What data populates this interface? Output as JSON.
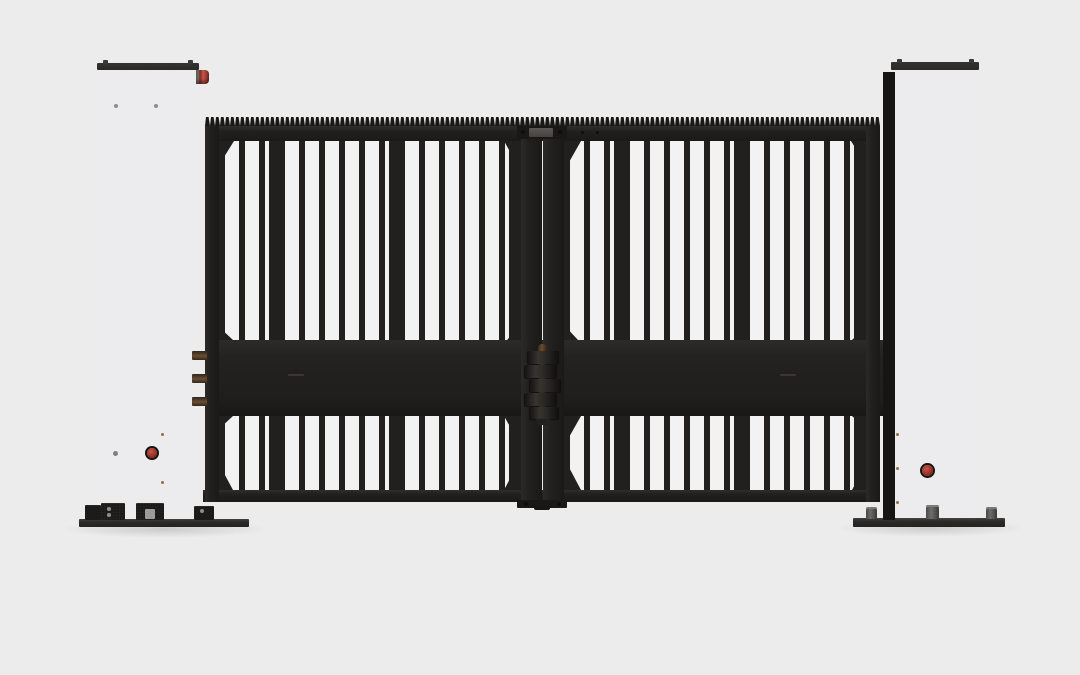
{
  "meta": {
    "type": "3d-product-render",
    "subject": "Black double-leaf swing gate with two square mounting posts on a plain light-gray studio background"
  },
  "scene": {
    "background": "plain light gray backdrop, no ground line",
    "left_post": "black square post with flat cap, two corner cap bolts, red side indicator light near the top right edge, two gray face bolts, red round button near the base, anchor base plate with fixing brackets and bolts",
    "right_post": "black square post with flat cap, corner cap bolts, visible darker left side face, red round button near the base, small side dots, anchor base plate with three anchor studs",
    "gate_left_leaf": "black leaf: serrated gear-rack top edge, top rail, upper vertical picket bars (periodic thicker bars), wide mid rail, lower picket bars, bottom rail, corner gussets, edge stiles",
    "gate_right_leaf": "mirror of left leaf",
    "center_hinge": "vertical stack of five interleaved hinge knuckles with a bronze pin between the two leaves at mid-rail height, plus small top and bottom center brackets",
    "left_hinge_lugs": "three bronze hinge lugs bridging the gap between the left post and the left leaf at mid-rail height"
  },
  "colors": {
    "bg": "#ececed",
    "bars-bg": "#f2f2f3",
    "gate": "#22201f",
    "gate-dark": "#191817",
    "beam": "#242220",
    "post": "#222120",
    "post-dark": "#161514",
    "post-cap": "#2c2a28",
    "plate": "#2b2a29",
    "bolt": "#8d8d8d",
    "amber": "#8f6f45",
    "brown": "#6b4c31",
    "brown-dark": "#3a2c1f",
    "red": "#9c2f27",
    "red-hi": "#c4564a"
  }
}
